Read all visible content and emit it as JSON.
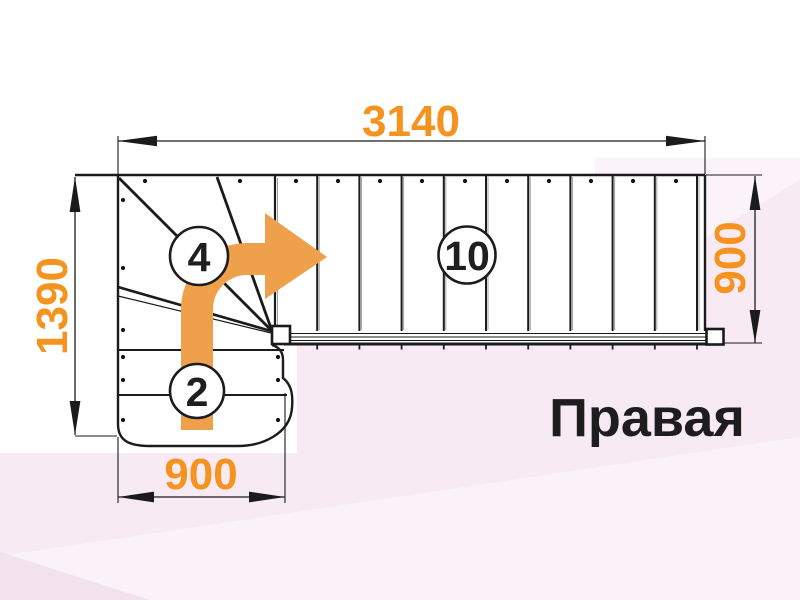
{
  "title": {
    "text": "Правая"
  },
  "dimensions": {
    "top": "3140",
    "left": "1390",
    "right": "900",
    "bottom": "900"
  },
  "step_counts": {
    "winder_flight": "4",
    "upper_flight": "10",
    "lower_flight": "2"
  },
  "icons": {
    "direction_arrow": "curved-right-arrow"
  },
  "colors": {
    "dimension_text": "#f6921e",
    "arrow": "#efa04b",
    "line": "#1b1b1b",
    "background_pink": "#f7eaf3",
    "paper": "#ffffff"
  }
}
